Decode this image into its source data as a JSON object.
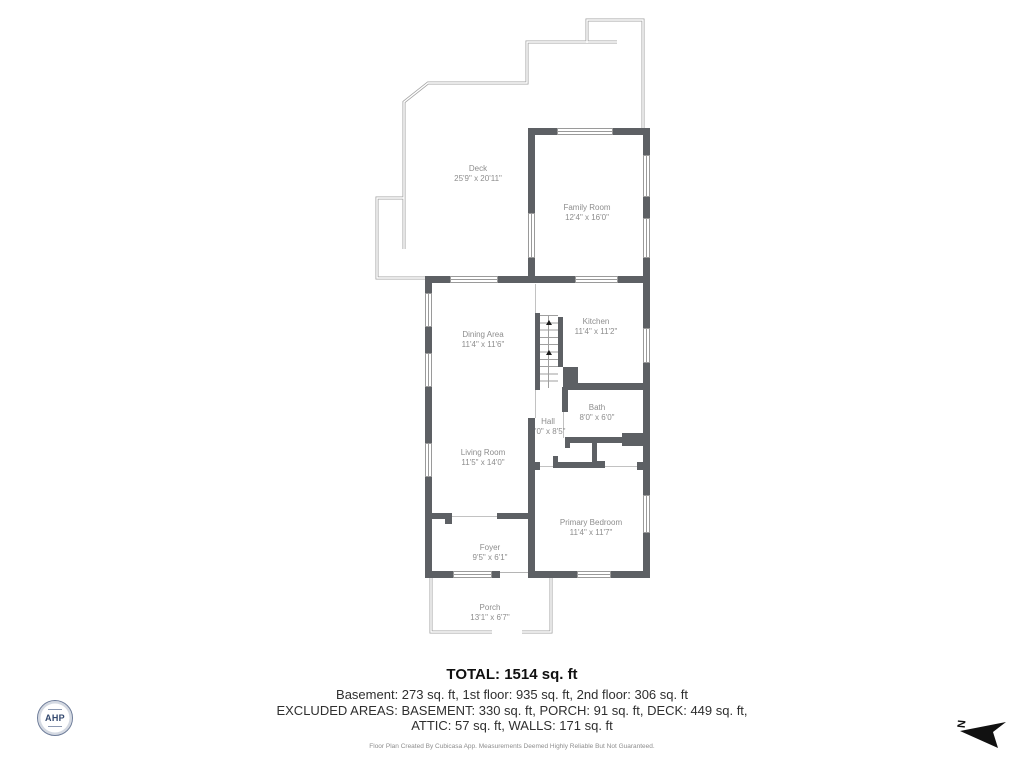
{
  "plan": {
    "rooms": {
      "deck": {
        "name": "Deck",
        "dims": "25'9\" x 20'11\""
      },
      "family_room": {
        "name": "Family Room",
        "dims": "12'4\" x 16'0\""
      },
      "dining_area": {
        "name": "Dining Area",
        "dims": "11'4\" x 11'6\""
      },
      "kitchen": {
        "name": "Kitchen",
        "dims": "11'4\" x 11'2\""
      },
      "bath": {
        "name": "Bath",
        "dims": "8'0\" x 6'0\""
      },
      "hall": {
        "name": "Hall",
        "dims": "3'0\" x 8'5\""
      },
      "living_room": {
        "name": "Living Room",
        "dims": "11'5\" x 14'0\""
      },
      "primary_bedroom": {
        "name": "Primary Bedroom",
        "dims": "11'4\" x 11'7\""
      },
      "foyer": {
        "name": "Foyer",
        "dims": "9'5\" x 6'1\""
      },
      "porch": {
        "name": "Porch",
        "dims": "13'1\" x 6'7\""
      }
    },
    "compass_label": "N"
  },
  "summary": {
    "total": "TOTAL: 1514 sq. ft",
    "floors": "Basement: 273 sq. ft, 1st floor: 935 sq. ft, 2nd floor: 306 sq. ft",
    "excluded_1": "EXCLUDED AREAS: BASEMENT: 330 sq. ft, PORCH: 91 sq. ft, DECK: 449 sq. ft,",
    "excluded_2": "ATTIC: 57 sq. ft, WALLS: 171 sq. ft"
  },
  "footer": {
    "disclaimer": "Floor Plan Created By Cubicasa App. Measurements Deemed Highly Reliable But Not Guaranteed."
  },
  "logo": {
    "text": "AHP"
  },
  "colors": {
    "wall": "#5d6064",
    "railing": "#a3a3a3",
    "label": "#8d8d8d",
    "logo_navy": "#33486e"
  }
}
